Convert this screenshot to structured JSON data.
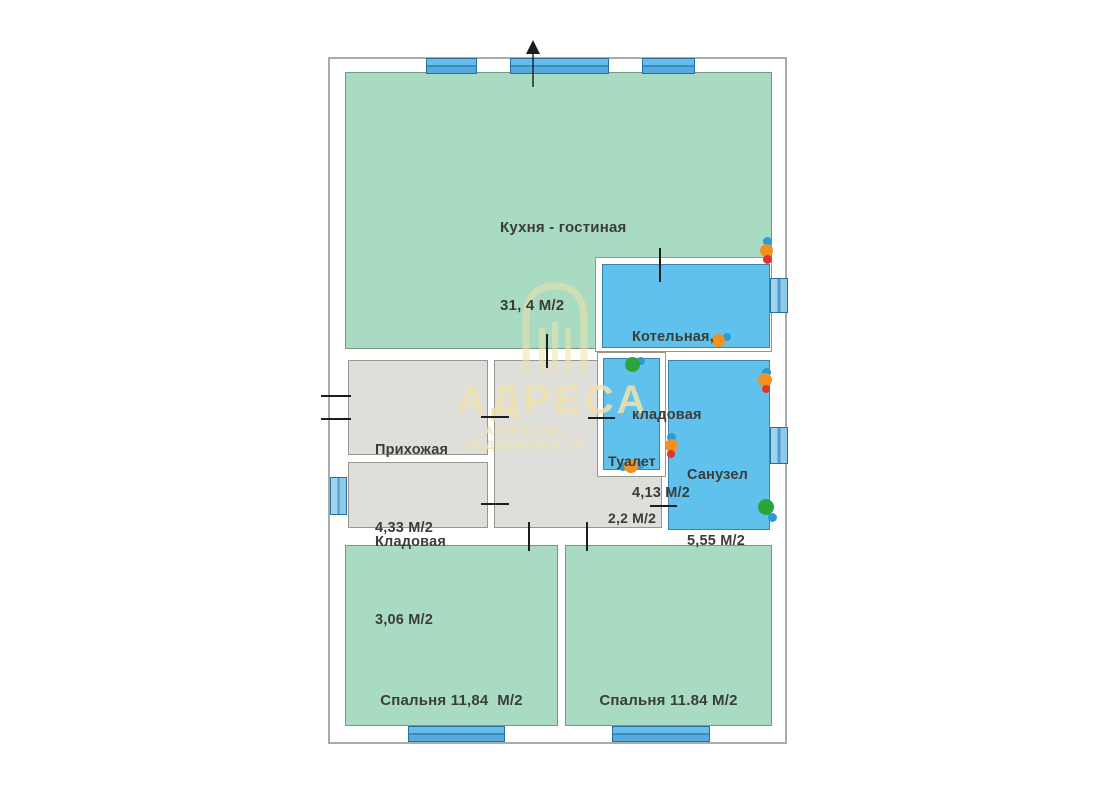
{
  "plan": {
    "type": "floor-plan",
    "units_suffix": "М/2",
    "rooms": [
      {
        "id": "kitchen-living",
        "lines": [
          "Кухня - гостиная",
          "31, 4 М/2"
        ]
      },
      {
        "id": "boiler-storage",
        "lines": [
          "Котельная,",
          "кладовая",
          "4,13 М/2"
        ]
      },
      {
        "id": "hallway",
        "lines": [
          "Прихожая",
          "4,33 М/2"
        ]
      },
      {
        "id": "pantry",
        "lines": [
          "Кладовая",
          "3,06 М/2"
        ]
      },
      {
        "id": "toilet",
        "lines": [
          "Туалет",
          "2,2 М/2"
        ]
      },
      {
        "id": "bathroom",
        "lines": [
          "Санузел",
          "5,55 М/2"
        ]
      },
      {
        "id": "bedroom-left",
        "lines": [
          "Спальня 11,84  М/2"
        ]
      },
      {
        "id": "bedroom-right",
        "lines": [
          "Спальня 11.84 М/2"
        ]
      }
    ],
    "watermark": {
      "brand": "АДРЕСА",
      "subtitle": "АГЕНТСТВО НЕДВИЖИМОСТИ"
    },
    "colors": {
      "room_green": "#a9dbc2",
      "room_blue": "#5fc1ec",
      "room_gray": "#dedfda",
      "wall_white": "#ffffff",
      "window_blue": "#55abdf",
      "marker_orange": "#f29022",
      "marker_blue": "#2e9ad2",
      "marker_red": "#e23333",
      "marker_green": "#2aa53c",
      "watermark_yellow": "#f0e2ac",
      "text_dark": "#3a3d3a"
    },
    "markers": [
      {
        "type": "socket-group",
        "dots": [
          {
            "x": 767,
            "y": 241,
            "d": 9,
            "c": "#2e9ad2"
          },
          {
            "x": 766,
            "y": 250,
            "d": 13,
            "c": "#f29022"
          },
          {
            "x": 767,
            "y": 259,
            "d": 9,
            "c": "#e23333"
          }
        ]
      },
      {
        "type": "socket-group",
        "dots": [
          {
            "x": 727,
            "y": 337,
            "d": 8,
            "c": "#2e9ad2"
          },
          {
            "x": 718,
            "y": 340,
            "d": 13,
            "c": "#f29022"
          }
        ]
      },
      {
        "type": "switch-group",
        "dots": [
          {
            "x": 641,
            "y": 361,
            "d": 8,
            "c": "#2e9ad2"
          },
          {
            "x": 632,
            "y": 364,
            "d": 15,
            "c": "#2aa53c"
          }
        ]
      },
      {
        "type": "socket-group",
        "dots": [
          {
            "x": 623,
            "y": 467,
            "d": 8,
            "c": "#2e9ad2"
          },
          {
            "x": 640,
            "y": 465,
            "d": 8,
            "c": "#2e9ad2"
          },
          {
            "x": 631,
            "y": 466,
            "d": 14,
            "c": "#f29022"
          }
        ]
      },
      {
        "type": "socket-group",
        "dots": [
          {
            "x": 671,
            "y": 437,
            "d": 9,
            "c": "#2e9ad2"
          },
          {
            "x": 671,
            "y": 445,
            "d": 13,
            "c": "#f29022"
          },
          {
            "x": 671,
            "y": 454,
            "d": 8,
            "c": "#e23333"
          }
        ]
      },
      {
        "type": "socket-group",
        "dots": [
          {
            "x": 766,
            "y": 372,
            "d": 9,
            "c": "#2e9ad2"
          },
          {
            "x": 765,
            "y": 380,
            "d": 14,
            "c": "#f29022"
          },
          {
            "x": 766,
            "y": 389,
            "d": 8,
            "c": "#e23333"
          }
        ]
      },
      {
        "type": "switch-group",
        "dots": [
          {
            "x": 772,
            "y": 517,
            "d": 9,
            "c": "#2e9ad2"
          },
          {
            "x": 766,
            "y": 507,
            "d": 16,
            "c": "#2aa53c"
          }
        ]
      }
    ]
  }
}
